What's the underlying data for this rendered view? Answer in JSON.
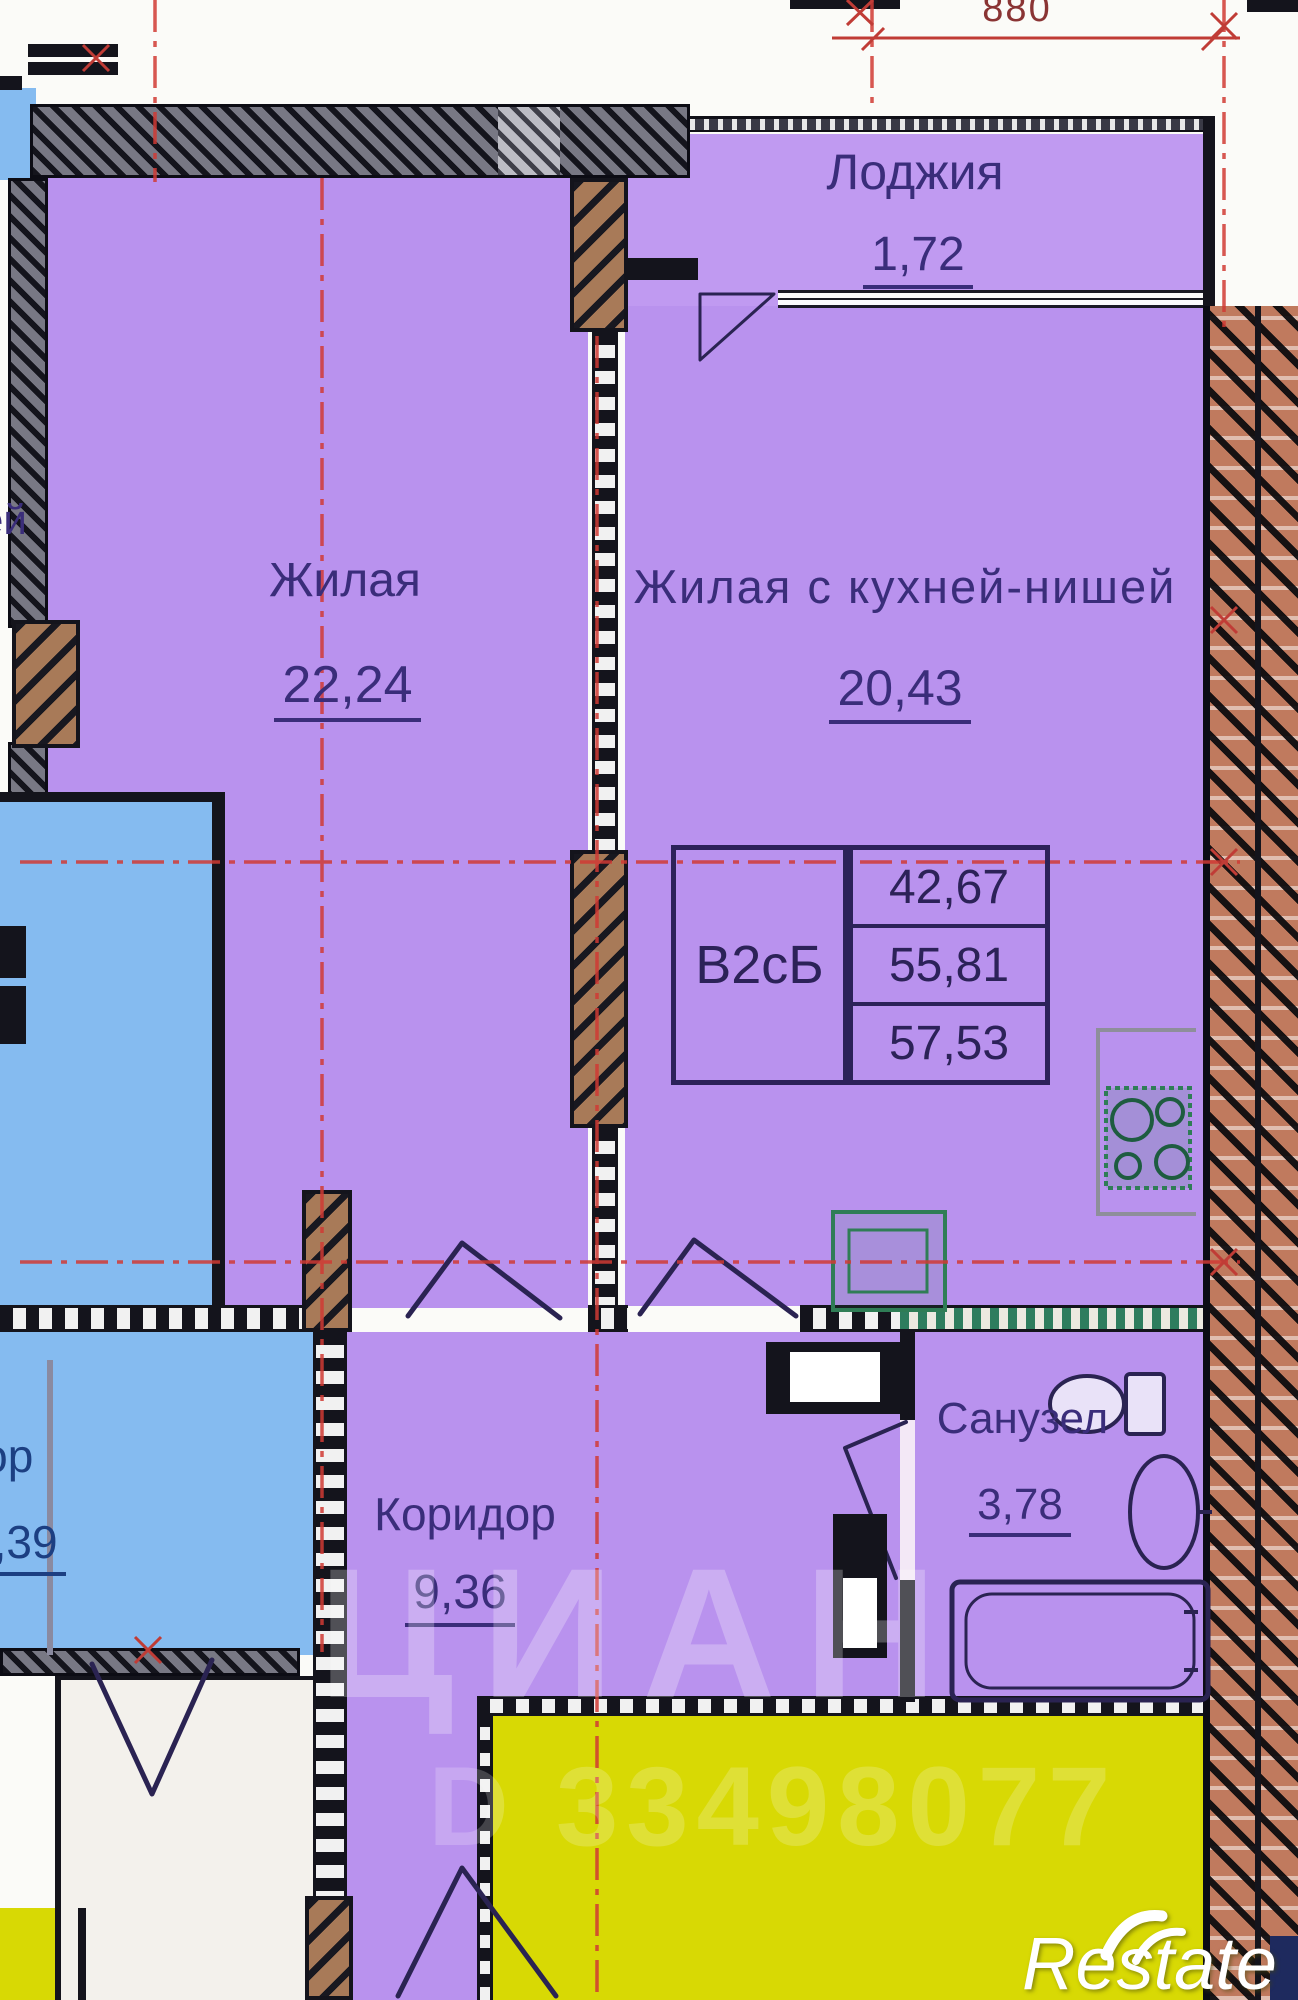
{
  "floorplan": {
    "unit": {
      "label": "В2сБ",
      "area_living": "42,67",
      "area_apartment": "55,81",
      "area_total": "57,53"
    },
    "rooms": {
      "loggia": {
        "name": "Лоджия",
        "area": "1,72"
      },
      "living": {
        "name": "Жилая",
        "area": "22,24"
      },
      "living_kitchen": {
        "name": "Жилая с кухней-нишей",
        "area": "20,43"
      },
      "corridor": {
        "name": "Коридор",
        "area": "9,36"
      },
      "bathroom": {
        "name": "Санузел",
        "area": "3,78"
      }
    },
    "neighbor": {
      "corridor_name": "ридор",
      "corridor_area": "7,39",
      "room_fragment": "ей"
    },
    "dimension_top": "880",
    "watermarks": {
      "brand": "ЦИАН",
      "listing_id": "D 33498077",
      "agency": "Restate"
    },
    "colors": {
      "room_fill": "#b992ee",
      "neighbor_blue": "#85bbf0",
      "neighbor_yellow": "#d8d904",
      "wall": "#14141c",
      "axis_red": "#d03a34",
      "label_ink": "#3a2d7a",
      "fixture_green": "#2f7d56"
    }
  }
}
